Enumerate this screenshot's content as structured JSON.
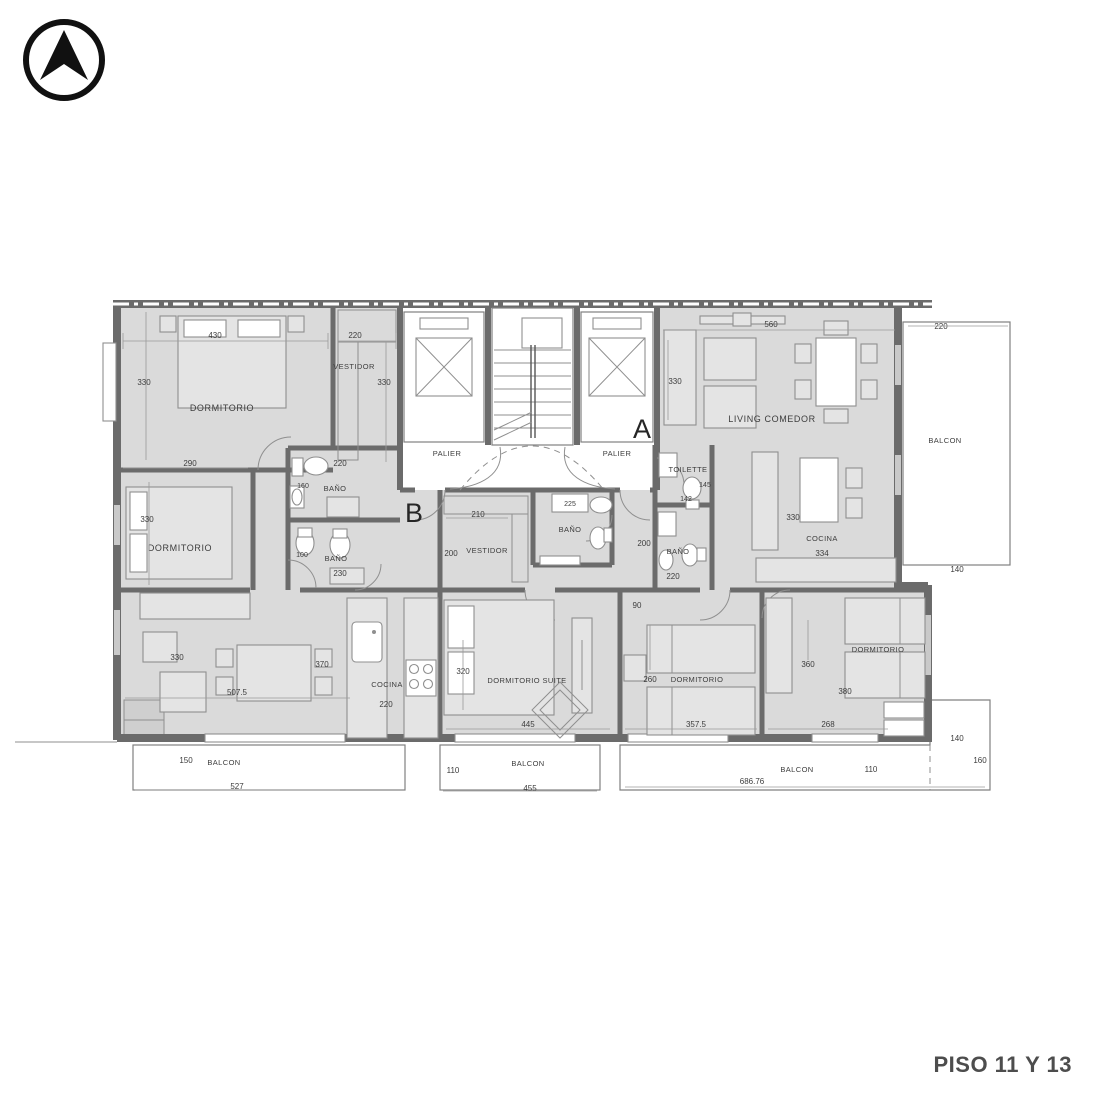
{
  "page": {
    "title": "PISO 11 Y 13"
  },
  "balcon_center": {
    "label": "BALCON",
    "h": "110",
    "w": "455"
  },
  "unit_b": {
    "letter": "B",
    "palier": "PALIER",
    "dorm_top": {
      "label": "DORMITORIO",
      "w": "430",
      "h": "330"
    },
    "vestidor": {
      "label": "VESTIDOR",
      "w": "220",
      "h": "330"
    },
    "dorm_mid": {
      "label": "DORMITORIO",
      "w": "290",
      "h": "330"
    },
    "bano_upper": {
      "label": "BAÑO",
      "w": "220",
      "d": "160"
    },
    "bano_lower": {
      "label": "BAÑO",
      "d1": "100",
      "d2": "230"
    },
    "living": {
      "d1": "330",
      "d2": "370",
      "w": "507.5"
    },
    "cocina": {
      "label": "COCINA",
      "w": "220"
    },
    "balcon": {
      "label": "BALCON",
      "h": "150",
      "w": "527"
    }
  },
  "unit_a": {
    "letter": "A",
    "palier": "PALIER",
    "toilette": {
      "label": "TOILETTE",
      "d1": "145",
      "d2": "142"
    },
    "living": {
      "label": "LIVING COMEDOR",
      "w": "560",
      "h": "330"
    },
    "cocina": {
      "label": "COCINA",
      "h": "330",
      "w": "334"
    },
    "vestidor": {
      "label": "VESTIDOR",
      "w": "210",
      "h": "200"
    },
    "bano_center": {
      "label": "BAÑO",
      "d1": "225"
    },
    "bano_right": {
      "label": "BAÑO",
      "h": "200",
      "w": "220",
      "pass": "90"
    },
    "suite": {
      "label": "DORMITORIO SUITE",
      "h": "320",
      "w": "445"
    },
    "dorm_middle": {
      "label": "DORMITORIO",
      "h": "260",
      "w": "357.5"
    },
    "dorm_right": {
      "label": "DORMITORIO",
      "h": "360",
      "w2": "380",
      "w": "268"
    },
    "balcon_right": {
      "label": "BALCON",
      "w": "220",
      "d": "140"
    },
    "balcon_bottom": {
      "label": "BALCON",
      "h": "110",
      "w": "686.76",
      "d1": "140",
      "d2": "160"
    }
  }
}
